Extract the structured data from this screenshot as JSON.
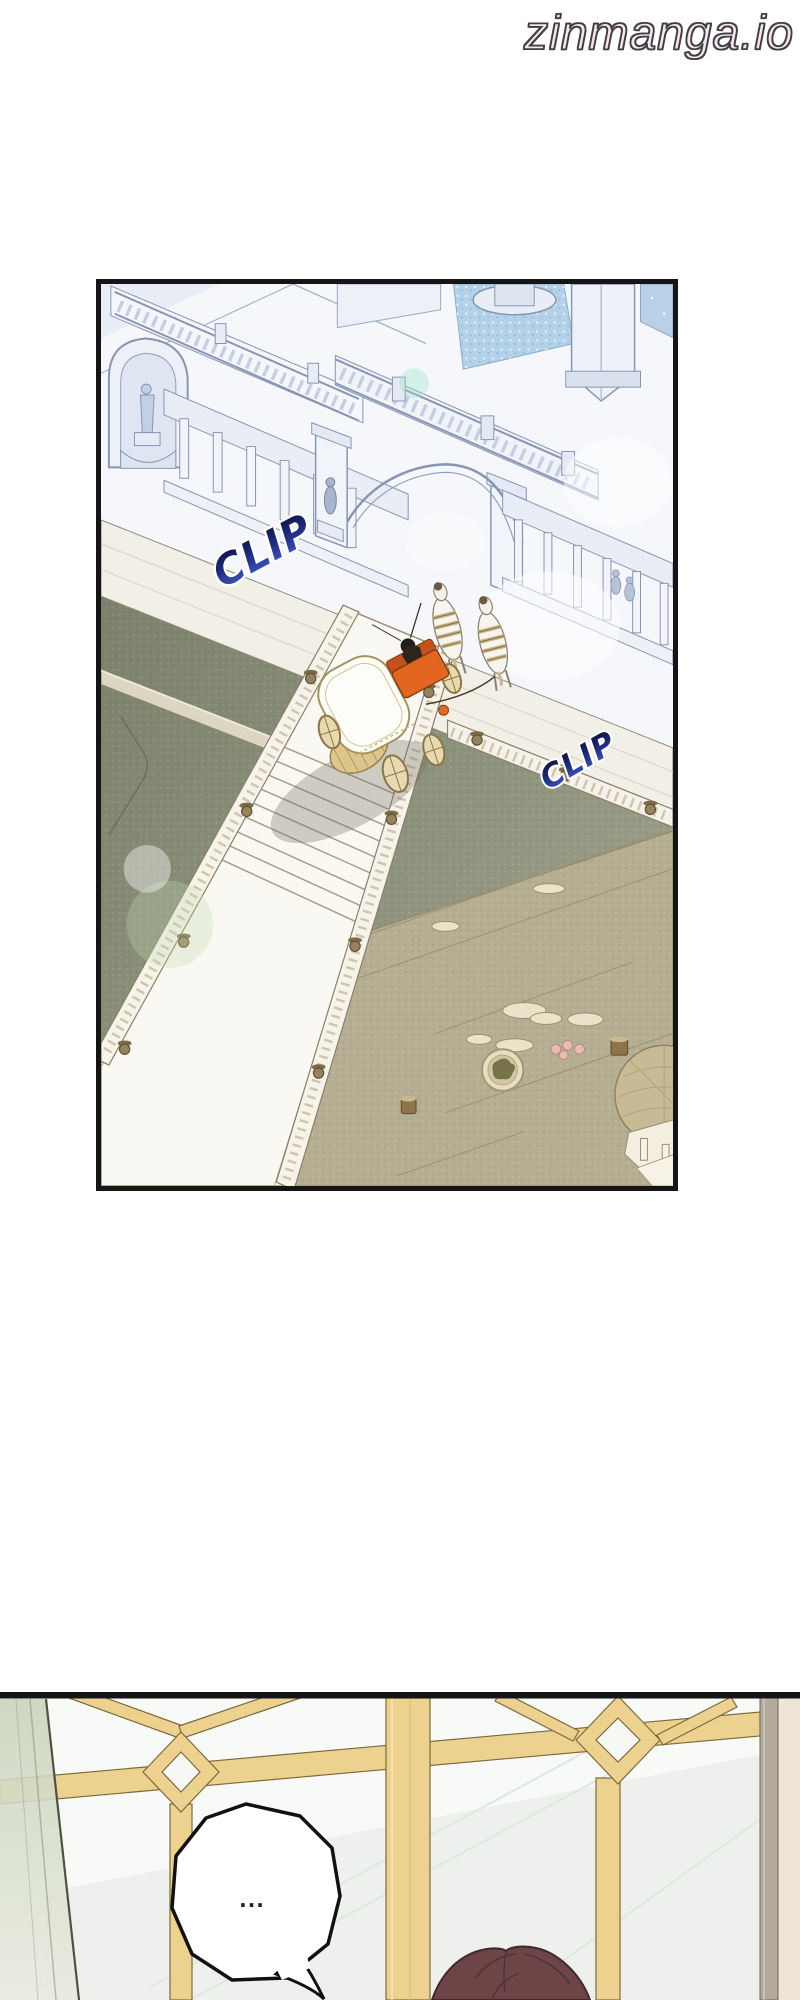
{
  "watermark": {
    "text": "zinmanga.io",
    "fill_color": "#f9e2f2",
    "outline_color": "#3f3f3f"
  },
  "main_panel": {
    "type": "manga-panel",
    "scene": "aerial isometric view of a palace courtyard: white carriage with horses on a road before an arched gate, long balustraded walkway with steps, green courtyard and khaki garden with round medallion and domed pavilion",
    "sfx": [
      {
        "text": "CLIP",
        "color_top": "#0c0c30",
        "color_bottom": "#4a63cf",
        "outline": "#ffffff"
      },
      {
        "text": "CLIP",
        "color_top": "#0c0c30",
        "color_bottom": "#4a63cf",
        "outline": "#ffffff"
      }
    ],
    "palette": {
      "architecture_line": "#8795b5",
      "architecture_fill": "#eef1f7",
      "fountain_water": "#b3d2e8",
      "courtyard_green": "#868b78",
      "garden_khaki": "#b6ae93",
      "walkway_cream": "#faf8f3",
      "carriage_orange": "#e2661f",
      "carriage_gold": "#dcc68c",
      "panel_border": "#151515"
    }
  },
  "bottom_panel": {
    "type": "manga-panel",
    "scene": "view through a gold lattice window with diamond motifs; green glass door pane at left; character with dark auburn hair at bottom under a speech bubble",
    "speech_bubble": {
      "text": "...",
      "fill": "#ffffff",
      "outline": "#111111"
    },
    "palette": {
      "lattice_gold": "#ecd28e",
      "lattice_edge": "#7d6a3c",
      "glass": "#f6f8f6",
      "door_pane_green": "#c9d3bd",
      "hair": "#6d4546",
      "panel_border": "#151515"
    }
  }
}
